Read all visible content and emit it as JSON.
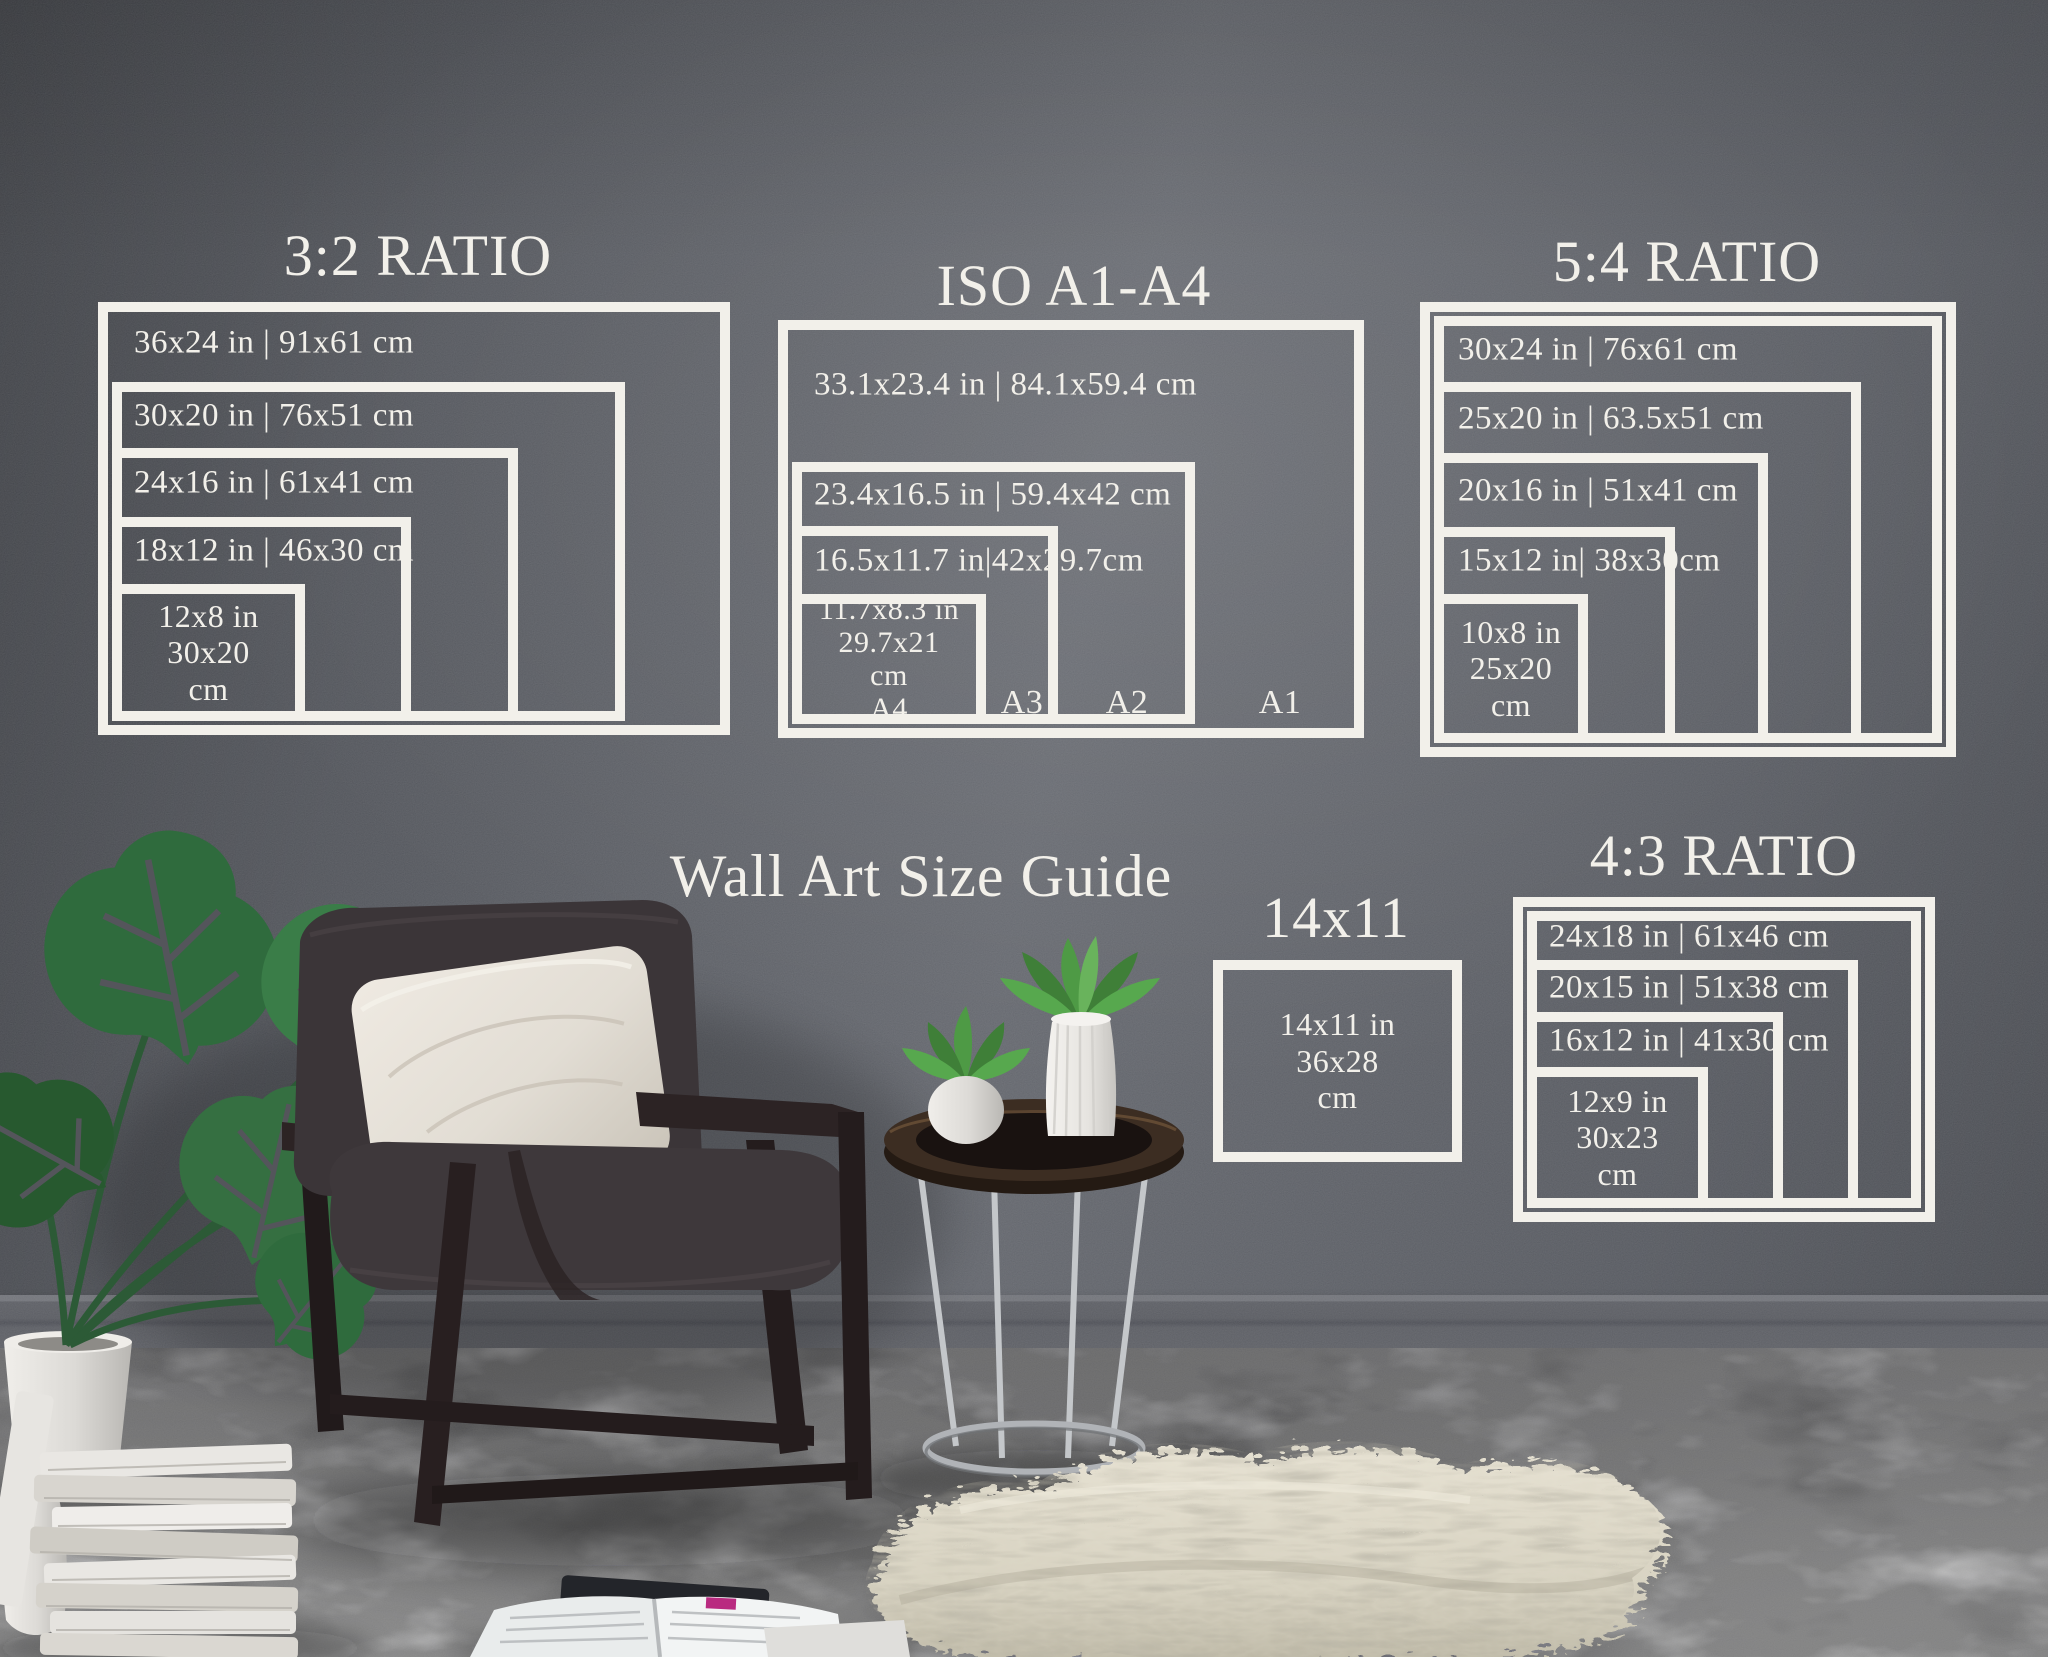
{
  "main_title": "Wall Art Size Guide",
  "sections": {
    "ratio32": {
      "title": "3:2 RATIO",
      "bands": [
        "36x24 in | 91x61 cm",
        "30x20 in | 76x51 cm",
        "24x16 in | 61x41 cm",
        "18x12 in | 46x30 cm"
      ],
      "smallest": [
        "12x8 in",
        "30x20",
        "cm"
      ]
    },
    "iso": {
      "title": "ISO A1-A4",
      "bands": [
        "33.1x23.4 in | 84.1x59.4 cm",
        "23.4x16.5 in | 59.4x42 cm",
        "16.5x11.7 in|42x29.7cm"
      ],
      "smallest": [
        "11.7x8.3 in",
        "29.7x21",
        "cm"
      ],
      "paper_sizes": [
        "A4",
        "A3",
        "A2",
        "A1"
      ]
    },
    "ratio54": {
      "title": "5:4 RATIO",
      "bands": [
        "30x24 in | 76x61 cm",
        "25x20 in | 63.5x51 cm",
        "20x16 in | 51x41 cm",
        "15x12 in| 38x30cm"
      ],
      "smallest": [
        "10x8 in",
        "25x20",
        "cm"
      ]
    },
    "single1411": {
      "title": "14x11",
      "smallest": [
        "14x11 in",
        "36x28",
        "cm"
      ]
    },
    "ratio43": {
      "title": "4:3 RATIO",
      "bands": [
        "24x18 in | 61x46 cm",
        "20x15 in | 51x38 cm",
        "16x12 in | 41x30 cm"
      ],
      "smallest": [
        "12x9 in",
        "30x23",
        "cm"
      ]
    }
  },
  "colors": {
    "line_and_text": "#f2f0ea",
    "wall": "#5e6168",
    "floor": "#828284",
    "rug": "#ded9c9",
    "plant": "#3a7d48",
    "wood": "#2a2122",
    "pillow": "#e7e2da",
    "cushion": "#3b3538"
  }
}
